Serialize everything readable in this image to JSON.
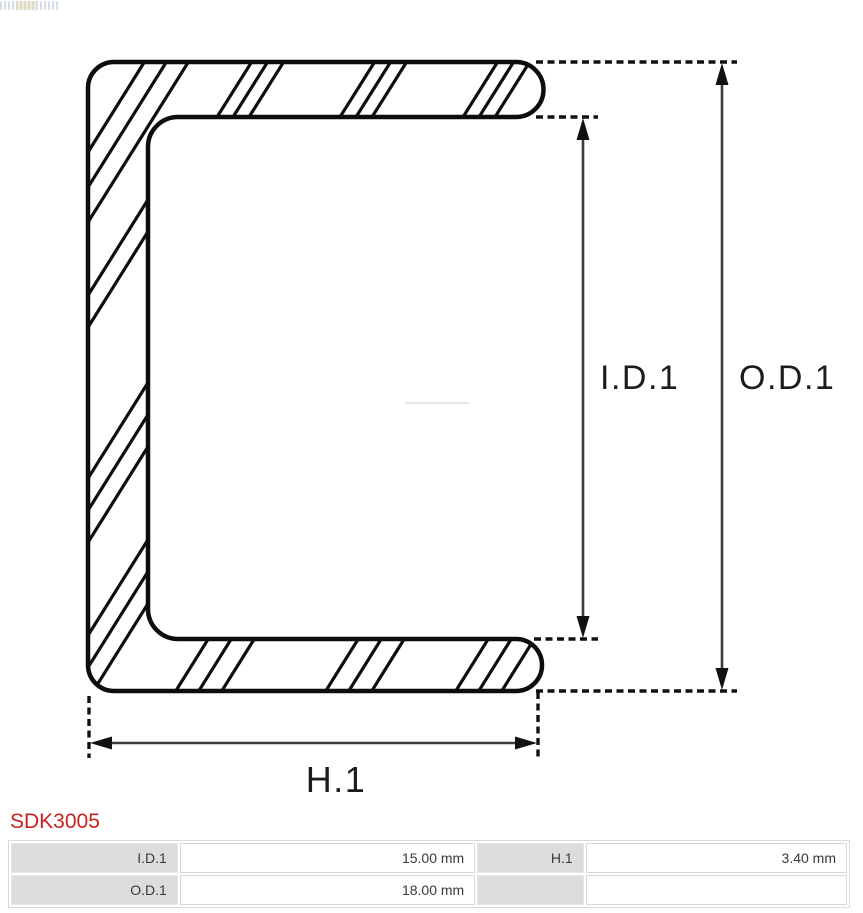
{
  "drawing": {
    "labels": {
      "inner_diameter": "I.D.1",
      "outer_diameter": "O.D.1",
      "height": "H.1"
    },
    "line_color": "#0d0d0d",
    "arrow_color": "#3c3c3c"
  },
  "part": {
    "code": "SDK3005",
    "code_color": "#cc1f1f"
  },
  "spec_table": {
    "rows": [
      {
        "c0_label": "I.D.1",
        "c1_value": "15.00 mm",
        "c2_label": "H.1",
        "c3_value": "3.40 mm"
      },
      {
        "c0_label": "O.D.1",
        "c1_value": "18.00 mm",
        "c2_label": "",
        "c3_value": ""
      }
    ]
  }
}
